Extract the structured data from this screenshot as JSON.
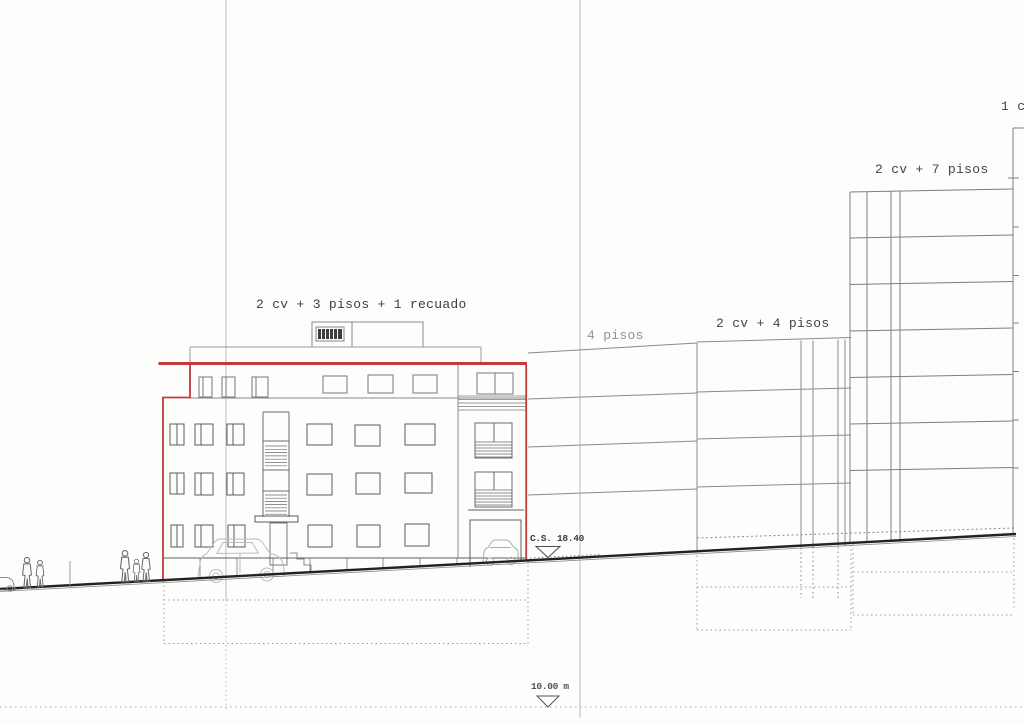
{
  "drawing": {
    "kind": "street elevation / alzado",
    "accent_outline_color": "#c23a3a",
    "line_color": "#5a5a5a"
  },
  "buildings": {
    "main": {
      "label": "2 cv + 3 pisos + 1 recuado"
    },
    "neighbor_4pisos": {
      "label": "4 pisos"
    },
    "neighbor_2cv_4pisos": {
      "label": "2 cv + 4 pisos"
    },
    "tower_2cv_7pisos": {
      "label": "2 cv + 7 pisos"
    },
    "edge_clipped": {
      "label": "1 c"
    }
  },
  "markers": {
    "street_level": {
      "label": "C.S. 18.40"
    },
    "reference_depth": {
      "label": "10.00 m"
    }
  }
}
